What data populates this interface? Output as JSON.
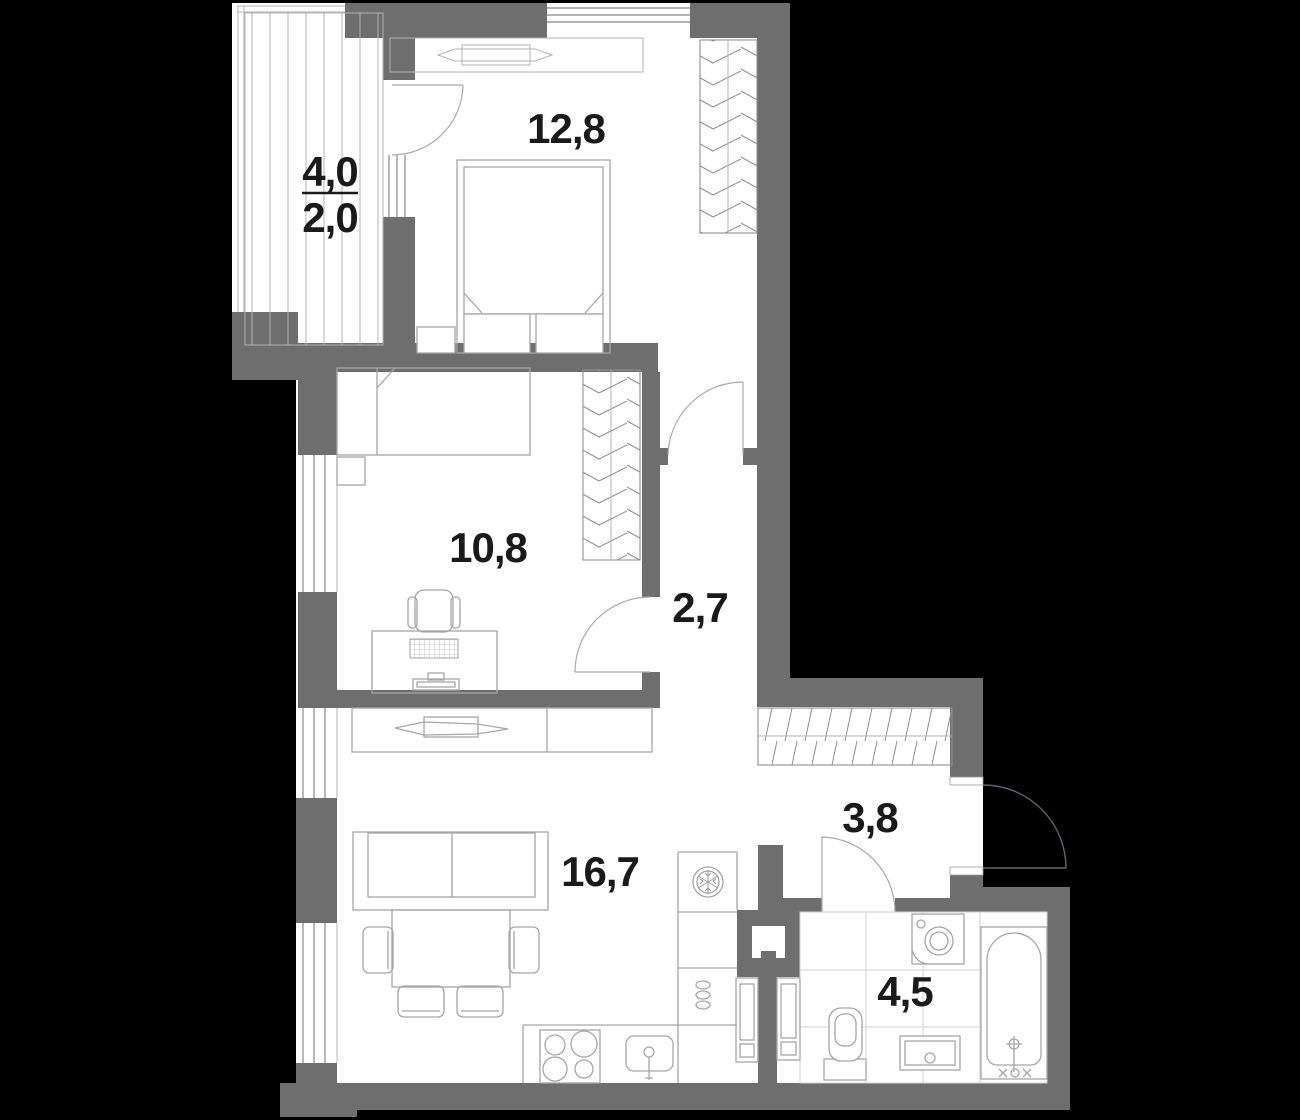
{
  "plan_title": "apartment-floor-plan",
  "colors": {
    "background": "#000000",
    "wall": "#6e6e6e",
    "floor": "#ffffff",
    "furniture_line": "#a6a6a6",
    "hatch_line": "#8f8f8f",
    "tile_line": "#d2d2d2",
    "label_text": "#1a1a1a"
  },
  "rooms": {
    "balcony": {
      "area_total": "4,0",
      "area_counted": "2,0"
    },
    "bedroom": {
      "area": "12,8"
    },
    "kids_room": {
      "area": "10,8"
    },
    "corridor": {
      "area": "2,7"
    },
    "hallway": {
      "area": "3,8"
    },
    "living_kitchen": {
      "area": "16,7"
    },
    "bathroom": {
      "area": "4,5"
    }
  },
  "icons": {
    "fridge": "snowflake-icon",
    "stove": "four-burner-icon",
    "washing_machine": "round-door-icon",
    "bath_faucet": "crosshair-icon"
  }
}
